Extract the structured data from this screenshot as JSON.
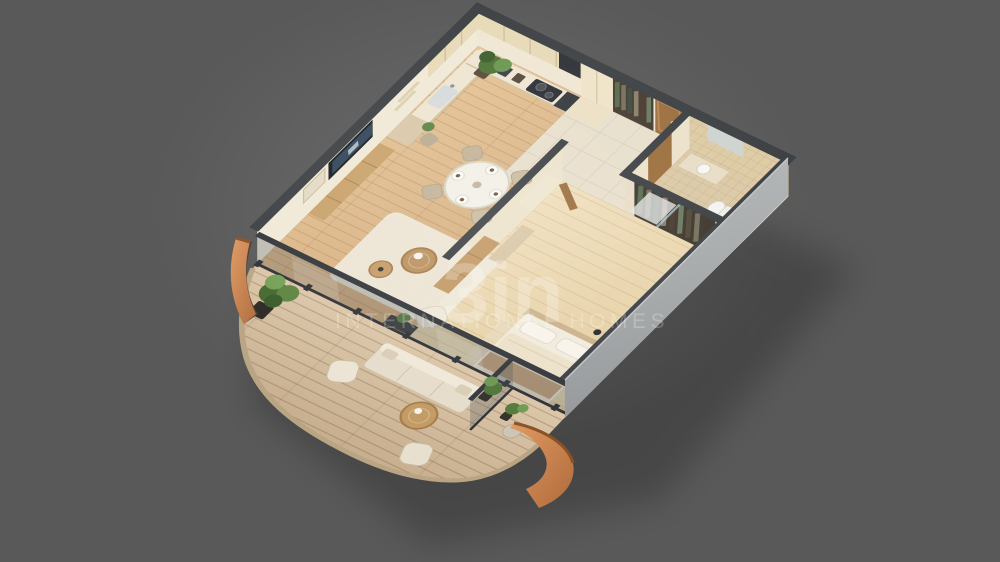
{
  "scene": {
    "kind": "isometric-3d-floor-plan-render",
    "description": "3D cutaway floor plan of a one-bedroom apartment with kitchen, entrance hall, bathroom, bedroom, living-dining room and a large curved balcony terrace",
    "background_color": "#595959",
    "rooms": [
      "kitchen",
      "entrance-hall",
      "bathroom",
      "bedroom",
      "living-dining-room",
      "balcony-terrace"
    ]
  },
  "watermark": {
    "logo_text": "3in",
    "title": "INTERNATIONAL HOMES",
    "color": "#ffffff"
  },
  "palette": {
    "wall_top": "#3e4144",
    "exterior_wall_face": "#a7aaab",
    "interior_wall_face": "#f0e8d4",
    "wood_floor": "#ddba8e",
    "bedroom_floor": "#ecd9b5",
    "hall_tile": "#e8dfcc",
    "bath_tile": "#dbc9a6",
    "deck_wood": "#d2bb9d",
    "cabinet_cream": "#e7dab8",
    "wood_furniture": "#c49a66",
    "door_wood": "#9c6f3e",
    "accent_orange": "#cc8050",
    "plant_green": "#5d8443",
    "upholstery": "#ebe4d3"
  }
}
